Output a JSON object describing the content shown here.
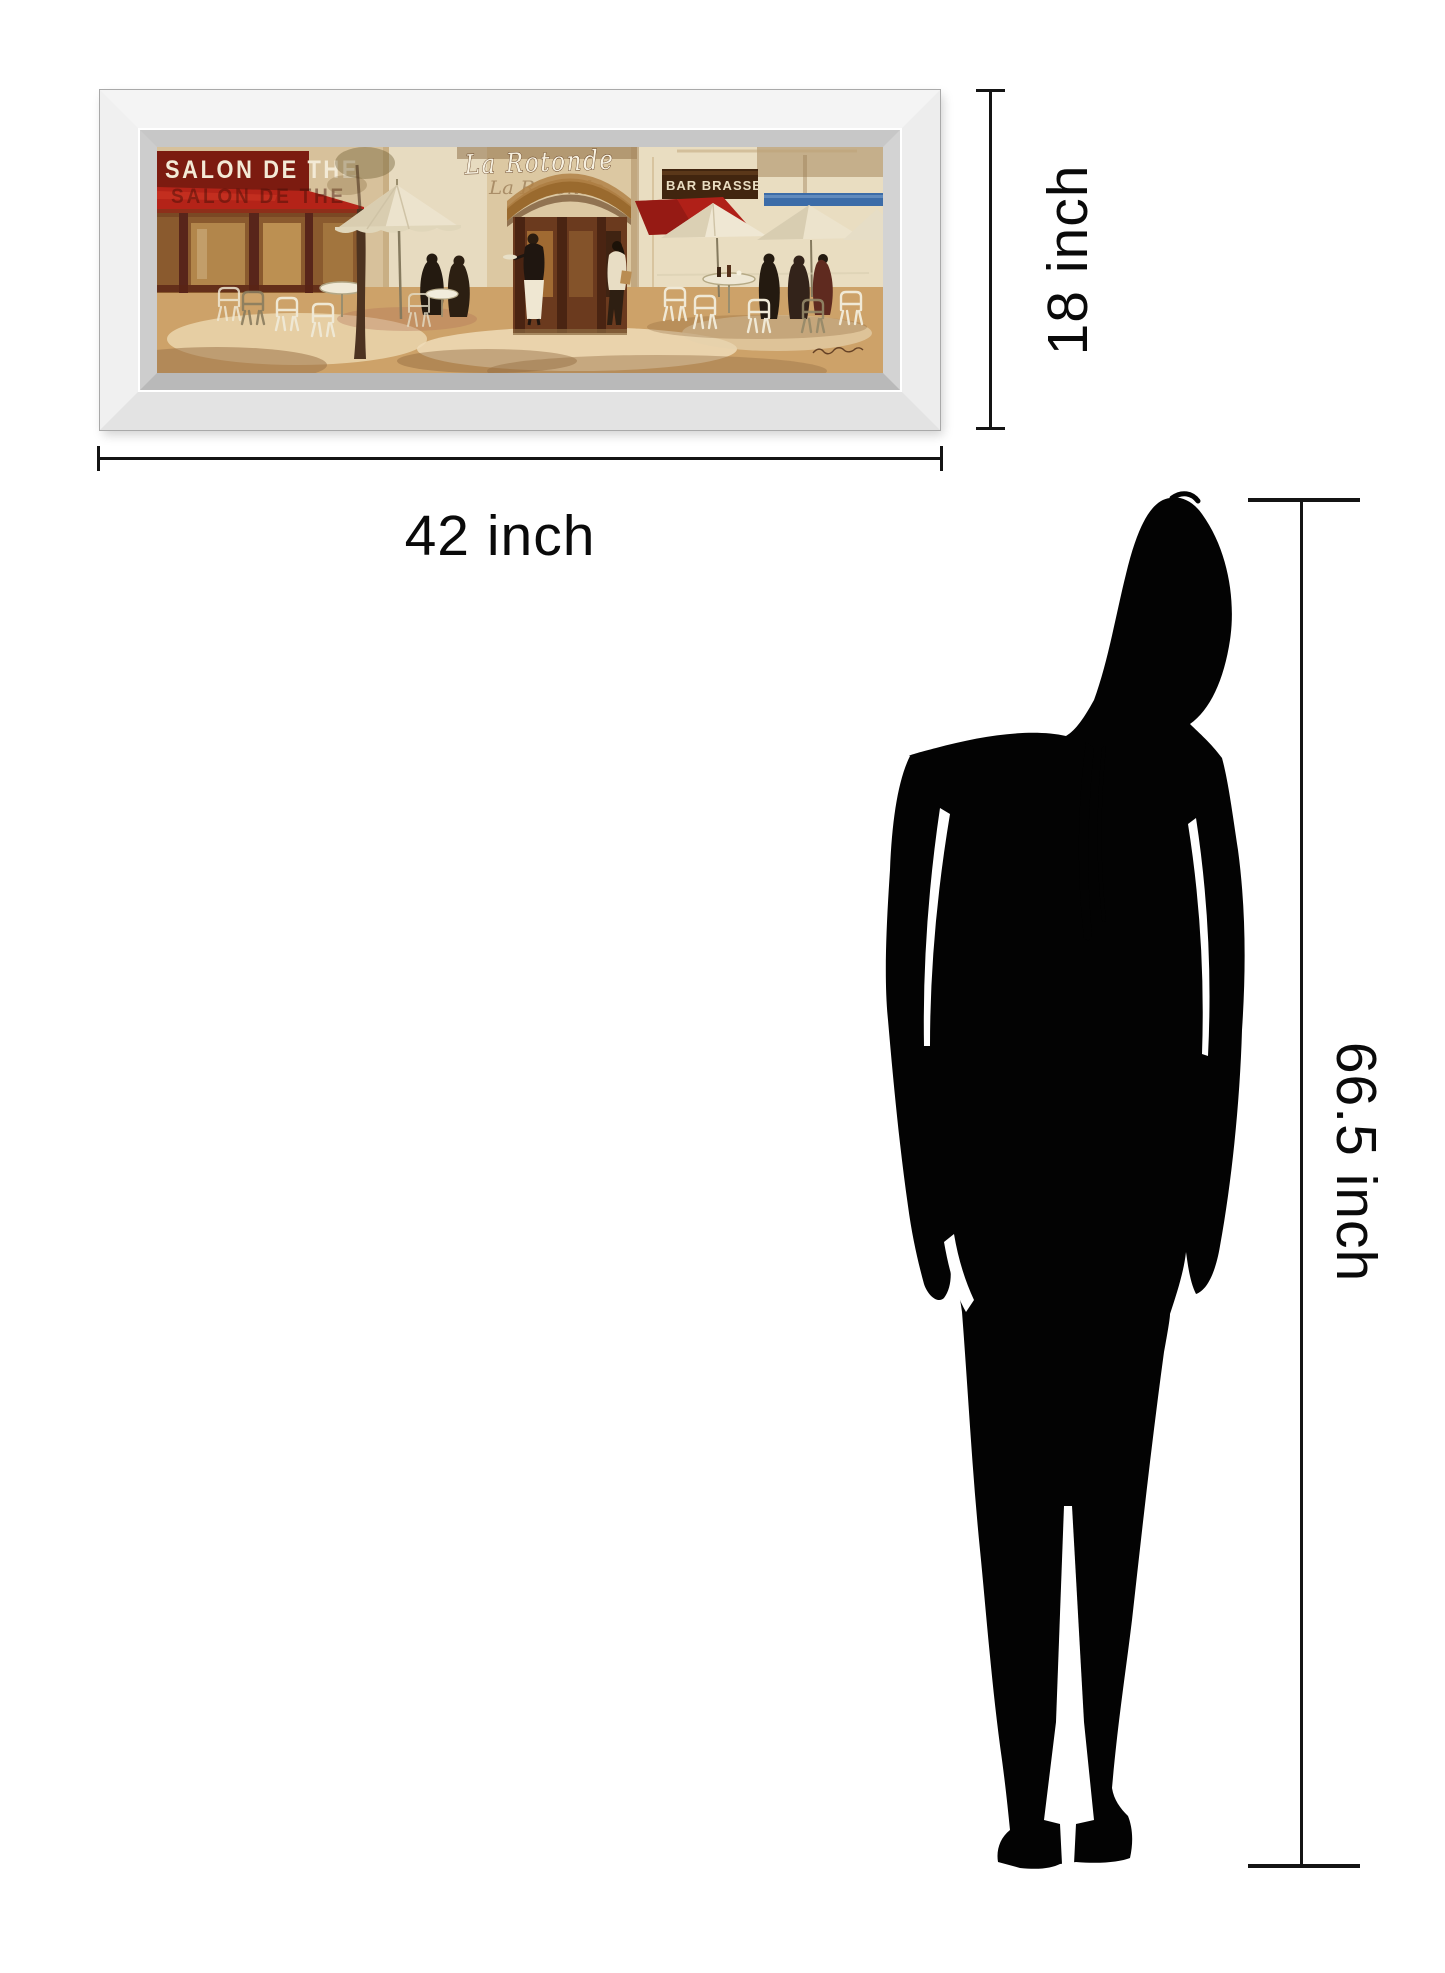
{
  "artwork": {
    "signs": {
      "salon": "SALON DE THE",
      "rotonde": "La Rotonde",
      "bar": "BAR BRASSERIE"
    }
  },
  "dimensions": {
    "width": "42 inch",
    "height": "18 inch",
    "person_height": "66.5 inch"
  },
  "colors": {
    "awning_red": "#b42318",
    "sign_blue": "#3c6ca8",
    "dimension_line": "#141414",
    "silhouette": "#030303",
    "frame_bevel": "#c7c7c7"
  }
}
